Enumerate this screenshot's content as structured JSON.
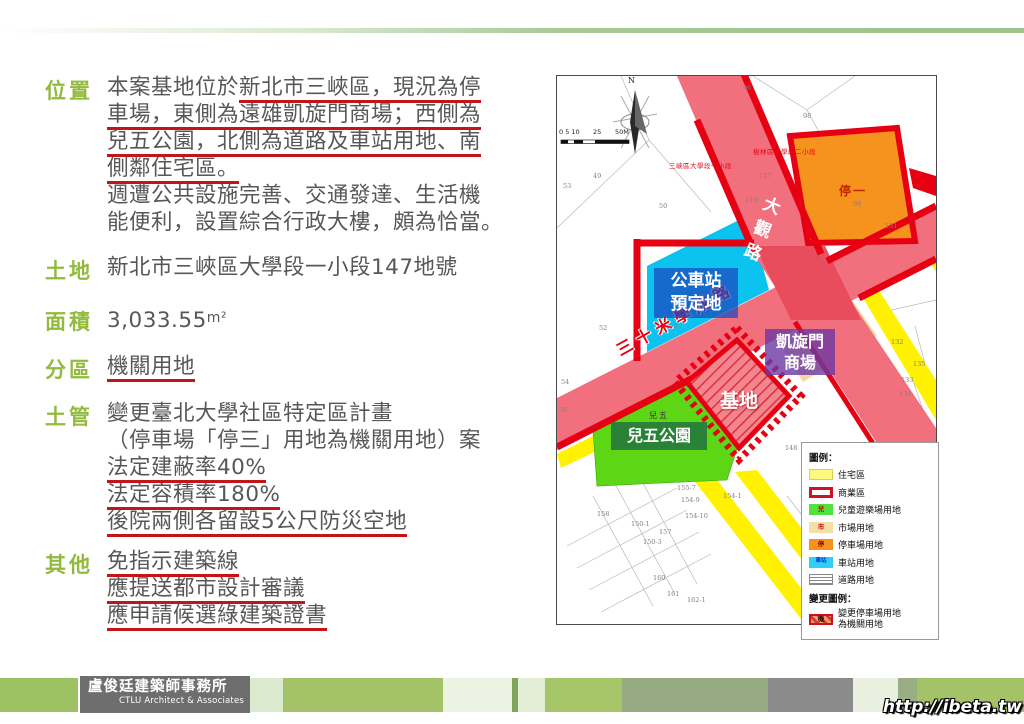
{
  "slide": {
    "sections": {
      "location": {
        "label": "位置",
        "l1_pre": "本案基地位於",
        "l1_u": "新北市三峽區，現況為停",
        "l2": "車場，東側為遠雄凱旋門商場；西側為",
        "l3": "兒五公園，北側為道路及車站用地、南",
        "l4": "側鄰住宅區。",
        "l5": "週遭公共設施完善、交通發達、生活機",
        "l6": "能便利，設置綜合行政大樓，頗為恰當。"
      },
      "land": {
        "label": "土地",
        "value": "新北市三峽區大學段一小段147地號"
      },
      "area": {
        "label": "面積",
        "value": "3,033.55",
        "unit": "m²"
      },
      "zoning": {
        "label": "分區",
        "value": "機關用地"
      },
      "landuse": {
        "label": "土管",
        "l1": "變更臺北大學社區特定區計畫",
        "l2": "（停車場「停三」用地為機關用地）案",
        "l3": "法定建蔽率40%",
        "l4": "法定容積率180%",
        "l5": "後院兩側各留設5公尺防災空地"
      },
      "other": {
        "label": "其他",
        "l1": "免指示建築線",
        "l2": "應提送都市設計審議",
        "l3": "應申請候選綠建築證書"
      }
    }
  },
  "map": {
    "north": "N",
    "scale": {
      "t1": "0 5 10",
      "t2": "25",
      "t3": "50M"
    },
    "district1": "三峽區大學段一小段",
    "district2": "樹林區大學段二小段",
    "road_daguan": "大觀路",
    "road_xuecheng": "三十米學成路",
    "label_bus_1": "公車站",
    "label_bus_2": "預定地",
    "label_mall_1": "凱旋門",
    "label_mall_2": "商場",
    "label_site": "基地",
    "label_park": "兒五公園",
    "label_park_small": "兒五",
    "label_parking": "停一",
    "legend": {
      "title": "圖例：",
      "items": [
        "住宅區",
        "商業區",
        "兒童遊樂場用地",
        "市場用地",
        "停車場用地",
        "車站用地",
        "道路用地"
      ],
      "char_child": "兒",
      "char_market": "市",
      "char_parking": "停",
      "char_station": "車站",
      "char_change": "機",
      "change_title": "變更圖例：",
      "change_l1": "變更停車場用地",
      "change_l2": "為機關用地"
    },
    "colors": {
      "road_pink": "#f2707e",
      "zone_border_red": "#e60012",
      "residential_yellow": "#fff100",
      "park_green": "#5cd615",
      "station_cyan": "#0cc3f0",
      "parking_orange": "#f6921e",
      "market_tan": "#f6d99f",
      "section_label_green": "#92ba3d",
      "underline_red": "#c3141c"
    },
    "parcels": [
      {
        "n": "96",
        "x": 186,
        "y": 8
      },
      {
        "n": "98",
        "x": 246,
        "y": 36
      },
      {
        "n": "49",
        "x": 36,
        "y": 96
      },
      {
        "n": "53",
        "x": 6,
        "y": 106
      },
      {
        "n": "50",
        "x": 102,
        "y": 126
      },
      {
        "n": "117",
        "x": 202,
        "y": 96
      },
      {
        "n": "118",
        "x": 188,
        "y": 120
      },
      {
        "n": "99",
        "x": 296,
        "y": 124
      },
      {
        "n": "151",
        "x": 328,
        "y": 146
      },
      {
        "n": "52",
        "x": 42,
        "y": 248
      },
      {
        "n": "52-1",
        "x": 112,
        "y": 246
      },
      {
        "n": "132",
        "x": 334,
        "y": 262
      },
      {
        "n": "135",
        "x": 356,
        "y": 284
      },
      {
        "n": "133",
        "x": 344,
        "y": 300
      },
      {
        "n": "134",
        "x": 342,
        "y": 314
      },
      {
        "n": "148",
        "x": 228,
        "y": 368
      },
      {
        "n": "54",
        "x": 4,
        "y": 302
      },
      {
        "n": "56",
        "x": 2,
        "y": 330
      },
      {
        "n": "158",
        "x": 40,
        "y": 434
      },
      {
        "n": "150-1",
        "x": 74,
        "y": 444
      },
      {
        "n": "150-3",
        "x": 86,
        "y": 462
      },
      {
        "n": "157",
        "x": 102,
        "y": 452
      },
      {
        "n": "155-7",
        "x": 120,
        "y": 408
      },
      {
        "n": "154-9",
        "x": 124,
        "y": 420
      },
      {
        "n": "154-10",
        "x": 128,
        "y": 436
      },
      {
        "n": "154-1",
        "x": 166,
        "y": 416
      },
      {
        "n": "160",
        "x": 96,
        "y": 498
      },
      {
        "n": "161",
        "x": 110,
        "y": 514
      },
      {
        "n": "162-1",
        "x": 130,
        "y": 520
      }
    ]
  },
  "footer": {
    "firm": "盧俊廷建築師事務所",
    "firm_en": "CTLU Architect & Associates",
    "watermark": "http://ibeta.tw"
  }
}
